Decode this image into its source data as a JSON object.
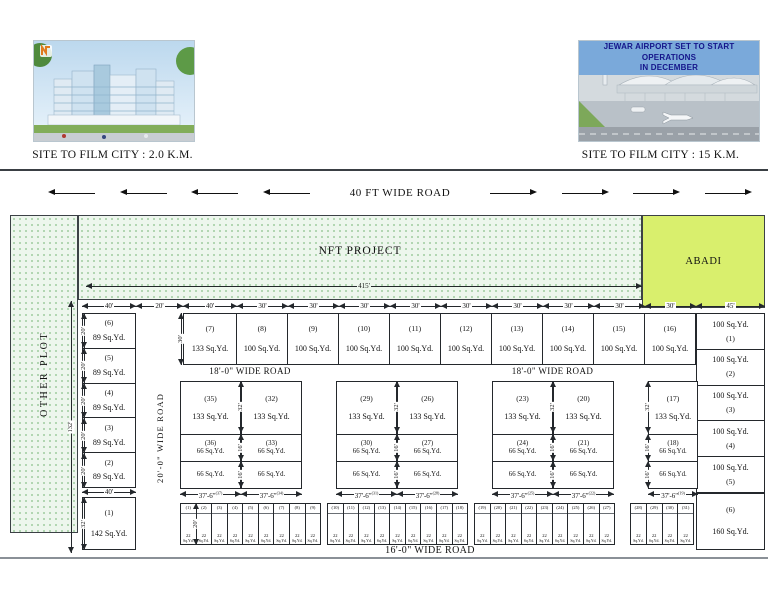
{
  "header": {
    "left_card": {
      "caption": "SITE TO FILM CITY : 2.0 K.M."
    },
    "right_card": {
      "banner_line1": "JEWAR AIRPORT SET TO START OPERATIONS",
      "banner_line2": "IN DECEMBER",
      "caption": "SITE TO FILM CITY : 15 K.M."
    }
  },
  "top_road": {
    "label": "40 FT WIDE ROAD"
  },
  "site": {
    "other_plot_label": "OTHER PLOT",
    "nft_label": "NFT PROJECT",
    "abadi_label": "ABADI",
    "width_dim": "415'",
    "height_dim": "132'",
    "roads": {
      "r18_left": "18'-0\" WIDE ROAD",
      "r18_right": "18'-0\" WIDE ROAD",
      "r20": "20'-0\" WIDE ROAD",
      "r16": "16'-0\" WIDE ROAD"
    },
    "top_dims": [
      "40'",
      "20'",
      "40'",
      "30'",
      "30'",
      "30'",
      "30'",
      "30'",
      "30'",
      "30'",
      "30'",
      "30'",
      "45'"
    ],
    "top_row_height_dim": "30'",
    "top_row_plots": [
      {
        "no": "(7)",
        "area": "133 Sq.Yd."
      },
      {
        "no": "(8)",
        "area": "100 Sq.Yd."
      },
      {
        "no": "(9)",
        "area": "100 Sq.Yd."
      },
      {
        "no": "(10)",
        "area": "100 Sq.Yd."
      },
      {
        "no": "(11)",
        "area": "100 Sq.Yd."
      },
      {
        "no": "(12)",
        "area": "100 Sq.Yd."
      },
      {
        "no": "(13)",
        "area": "100 Sq.Yd."
      },
      {
        "no": "(14)",
        "area": "100 Sq.Yd."
      },
      {
        "no": "(15)",
        "area": "100 Sq.Yd."
      },
      {
        "no": "(16)",
        "area": "100 Sq.Yd."
      }
    ],
    "left_column": {
      "row_dims": [
        "20'",
        "20'",
        "20'",
        "20'",
        "20'"
      ],
      "bottom_width_dim": "40'",
      "plot1_height_dim": "32'",
      "plots": [
        {
          "no": "(6)",
          "area": "89 Sq.Yd."
        },
        {
          "no": "(5)",
          "area": "89 Sq.Yd."
        },
        {
          "no": "(4)",
          "area": "89 Sq.Yd."
        },
        {
          "no": "(3)",
          "area": "89 Sq.Yd."
        },
        {
          "no": "(2)",
          "area": "89 Sq.Yd."
        }
      ],
      "plot1": {
        "no": "(1)",
        "area": "142 Sq.Yd."
      }
    },
    "right_column": {
      "plots": [
        {
          "no": "(1)",
          "area": "100 Sq.Yd."
        },
        {
          "no": "(2)",
          "area": "100 Sq.Yd."
        },
        {
          "no": "(3)",
          "area": "100 Sq.Yd."
        },
        {
          "no": "(4)",
          "area": "100 Sq.Yd."
        },
        {
          "no": "(5)",
          "area": "100 Sq.Yd."
        }
      ],
      "plot6": {
        "no": "(6)",
        "area": "160 Sq.Yd."
      }
    },
    "block_dims": {
      "h133": "32'",
      "h66": "16'",
      "col_width": "37'-6\""
    },
    "blocks": [
      {
        "columns": [
          {
            "top_no": "(35)",
            "top_area": "133 Sq.Yd.",
            "mid_no": "(36)",
            "mid_area": "66 Sq.Yd.",
            "bot_area": "66 Sq.Yd.",
            "bot_no_sup": "(37)"
          },
          {
            "top_no": "(32)",
            "top_area": "133 Sq.Yd.",
            "mid_no": "(33)",
            "mid_area": "66 Sq.Yd.",
            "bot_area": "66 Sq.Yd.",
            "bot_no_sup": "(34)"
          }
        ]
      },
      {
        "columns": [
          {
            "top_no": "(29)",
            "top_area": "133 Sq.Yd.",
            "mid_no": "(30)",
            "mid_area": "66 Sq.Yd.",
            "bot_area": "66 Sq.Yd.",
            "bot_no_sup": "(31)"
          },
          {
            "top_no": "(26)",
            "top_area": "133 Sq.Yd.",
            "mid_no": "(27)",
            "mid_area": "66 Sq.Yd.",
            "bot_area": "66 Sq.Yd.",
            "bot_no_sup": "(28)"
          }
        ]
      },
      {
        "columns": [
          {
            "top_no": "(23)",
            "top_area": "133 Sq.Yd.",
            "mid_no": "(24)",
            "mid_area": "66 Sq.Yd.",
            "bot_area": "66 Sq.Yd.",
            "bot_no_sup": "(25)"
          },
          {
            "top_no": "(20)",
            "top_area": "133 Sq.Yd.",
            "mid_no": "(21)",
            "mid_area": "66 Sq.Yd.",
            "bot_area": "66 Sq.Yd.",
            "bot_no_sup": "(22)"
          }
        ]
      },
      {
        "columns": [
          {
            "top_no": "(17)",
            "top_area": "133 Sq.Yd.",
            "mid_no": "(18)",
            "mid_area": "66 Sq.Yd.",
            "bot_area": "66 Sq.Yd.",
            "bot_no_sup": "(19)"
          }
        ]
      }
    ],
    "tiny_row": {
      "area_top": "22",
      "area_bottom": "Sq.Yd.",
      "height_dim": "20'",
      "groups": [
        [
          "(1)",
          "(2)",
          "(3)",
          "(4)",
          "(5)",
          "(6)",
          "(7)",
          "(8)",
          "(9)"
        ],
        [
          "(10)",
          "(11)",
          "(12)",
          "(13)",
          "(14)",
          "(15)",
          "(16)",
          "(17)",
          "(18)"
        ],
        [
          "(19)",
          "(20)",
          "(21)",
          "(22)",
          "(23)",
          "(24)",
          "(25)",
          "(26)",
          "(27)"
        ],
        [
          "(28)",
          "(29)",
          "(30)",
          "(31)"
        ]
      ]
    }
  },
  "colors": {
    "dot_area_bg": "#edf6ed",
    "dot_color": "#7cba7c",
    "abadi": "#d9ef6d",
    "banner_bg": "#7aa9da",
    "banner_text": "#15158a",
    "line": "#24282c"
  }
}
